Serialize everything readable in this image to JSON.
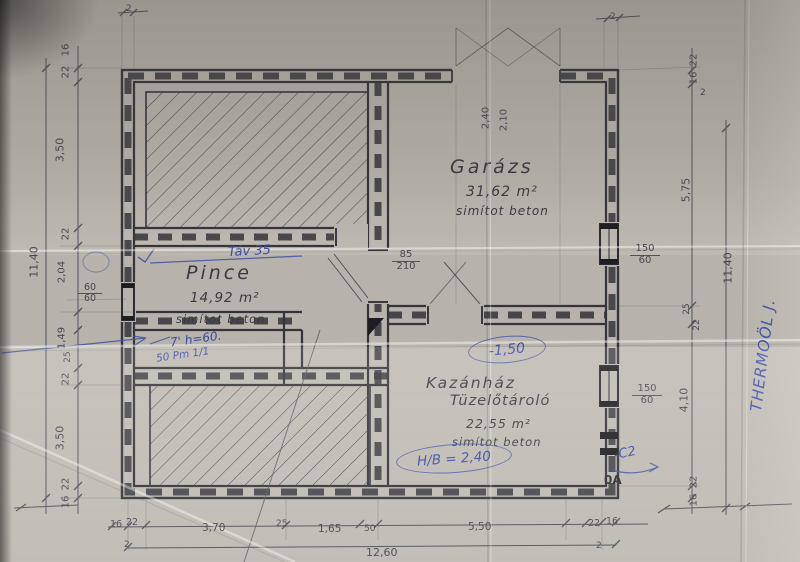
{
  "plan": {
    "rooms": {
      "garage": {
        "name": "Garázs",
        "area": "31,62 m²",
        "floor": "simítot beton"
      },
      "pince": {
        "name": "Pince",
        "area": "14,92 m²",
        "floor": "simítot beton"
      },
      "kazanhaz": {
        "name_line1": "Kazánház",
        "name_line2": "Tüzelőtároló",
        "area": "22,55 m²",
        "floor": "simítot beton"
      }
    },
    "doors": {
      "garage": {
        "width": "2,40",
        "height": "2,10"
      },
      "pince": {
        "width": "85",
        "height": "210"
      }
    },
    "windows": {
      "left": {
        "width": "60",
        "height": "60"
      },
      "garage_right": {
        "width": "150",
        "height": "60"
      },
      "kazanhaz_right": {
        "width": "150",
        "height": "60"
      }
    },
    "dims": {
      "left_chain": [
        "16",
        "22",
        "3,50",
        "22",
        "2,04",
        "1,49",
        "25",
        "22",
        "3,50",
        "22",
        "16"
      ],
      "left_total": "11,40",
      "right_chain": [
        "22",
        "16",
        "5,75",
        "25",
        "22",
        "4,10",
        "22",
        "16"
      ],
      "right_small": "2",
      "right_total": "11,40",
      "bottom_chain": [
        "16",
        "22",
        "3,70",
        "25",
        "1,65",
        "50",
        "5,50",
        "22",
        "16"
      ],
      "bottom_small_left": "2",
      "bottom_small_right": "2",
      "bottom_total": "12,60",
      "top_small_left": "2",
      "top_small_right": "2"
    },
    "handwritten": {
      "tav": "Táv 35",
      "level": "-1,50",
      "hb": "H/B = 2,40",
      "note_line1": "7' h=60.",
      "note_line2": "50 Pm 1/1",
      "c2": "-C2",
      "corner_mark": "0A",
      "side_note": "THERMOÖL J."
    }
  }
}
